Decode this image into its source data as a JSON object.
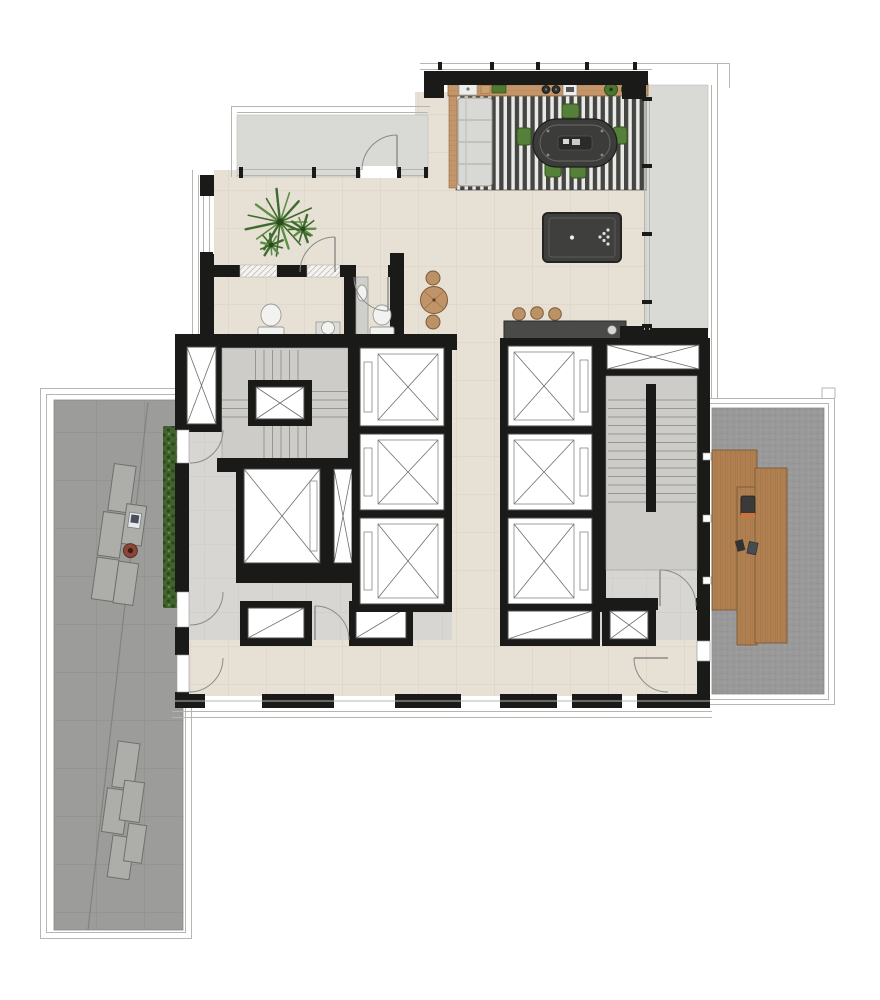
{
  "meta": {
    "title": "Penthouse amenity floor plan",
    "canvas": {
      "width": 880,
      "height": 1000
    },
    "visible_text": []
  },
  "colors": {
    "wall": "#1a1a18",
    "tile": "#e7e0d5",
    "tile-line": "#d9d0c3",
    "gray-floor": "#d7d6d2",
    "gray-line": "#c9c8c4",
    "balcony": "#d9d9d5",
    "rug-dark": "#454543",
    "rug-light": "#e9e9e6",
    "pavers": "#9c9c9a",
    "paver-line": "#8d8d8b",
    "carpet": "#99999a",
    "hedge": "#42632e",
    "hedge-dark": "#2c481d",
    "wood": "#b08050",
    "wood-dark": "#96693d",
    "bar-wood": "#c49568",
    "sofa": "#d8d8d4",
    "poker-table": "#3c3c3a",
    "chair-green": "#54803a",
    "chair-green-dark": "#36551f",
    "pool-table": "#3f3f3d",
    "counter-dark": "#4a4a48",
    "stair": "#cdccc8",
    "stair-line": "#97978f",
    "frame": "#b5b5b2",
    "arc": "#8a8a88",
    "fixture": "#f2f2f0",
    "bench": "#adadaa",
    "firebowl": "#8a4636",
    "palm": "#3f6b2f",
    "palm-light": "#5e8f46"
  },
  "areas": {
    "game_room": "game room with striped rug, card table, billiards table and bar",
    "balcony_top": "upper balcony strip",
    "balcony_right": "right balcony strip",
    "bathrooms": "two WC rooms with toilets and sinks",
    "core": "elevator and stair core with seven elevator cars and two stairs",
    "corridor": "lower corridor",
    "terrace_left": "paved terrace with benches, laptop table, fire bowl and hedge",
    "terrace_right": "carpeted terrace with wood deck platforms",
    "terrace_bottom": "lower paved terrace with benches"
  },
  "furniture": [
    "sofa",
    "card-table",
    "green-chairs",
    "billiard-table",
    "bar-counter",
    "bar-sink",
    "bar-plants",
    "kitchen-counter",
    "counter-stools",
    "round-table",
    "palm-plants",
    "toilets",
    "sinks",
    "benches",
    "laptop",
    "fire-bowl",
    "deck-chair",
    "wood-deck"
  ]
}
